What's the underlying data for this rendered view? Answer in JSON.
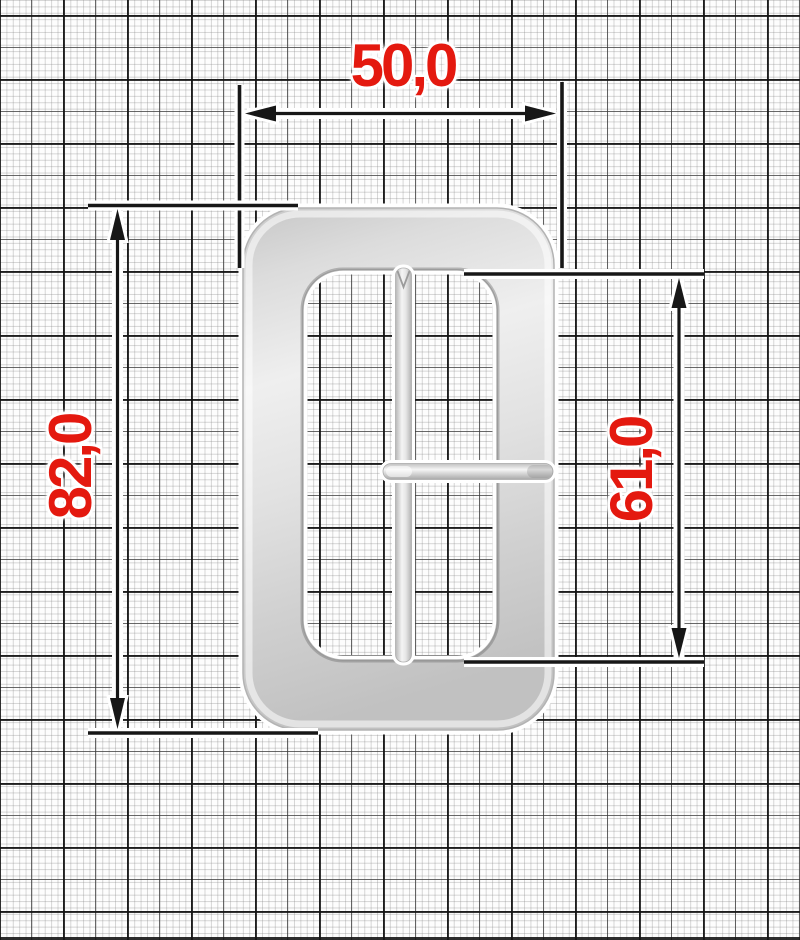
{
  "figure": {
    "description": "Technical dimension drawing of a metal rectangular strap buckle with a vertical center bar and a horizontal prong, photographed as a cutout with a white halo and placed over millimeter graph paper",
    "grid": "millimeter paper: fine 1 mm lines, heavier 5 mm and 10 mm lines"
  },
  "dimensions": {
    "width": {
      "label": "50,0",
      "value": 50.0,
      "placement": "top, horizontal double-headed arrow"
    },
    "height": {
      "label": "82,0",
      "value": 82.0,
      "placement": "left, vertical double-headed arrow, text rotated 90°"
    },
    "inner_height": {
      "label": "61,0",
      "value": 61.0,
      "placement": "right, vertical double-headed arrow, text rotated 90°"
    }
  },
  "colors": {
    "dimension_text": "#e4190f",
    "dimension_line": "#171717",
    "metal_highlight": "#f0f0f0",
    "metal_midtone": "#d8d8d8",
    "metal_shadow": "#b9b9b9",
    "grid_minor_line": "#cccccc",
    "grid_major_line": "#262626",
    "paper": "#fdfdfd"
  }
}
